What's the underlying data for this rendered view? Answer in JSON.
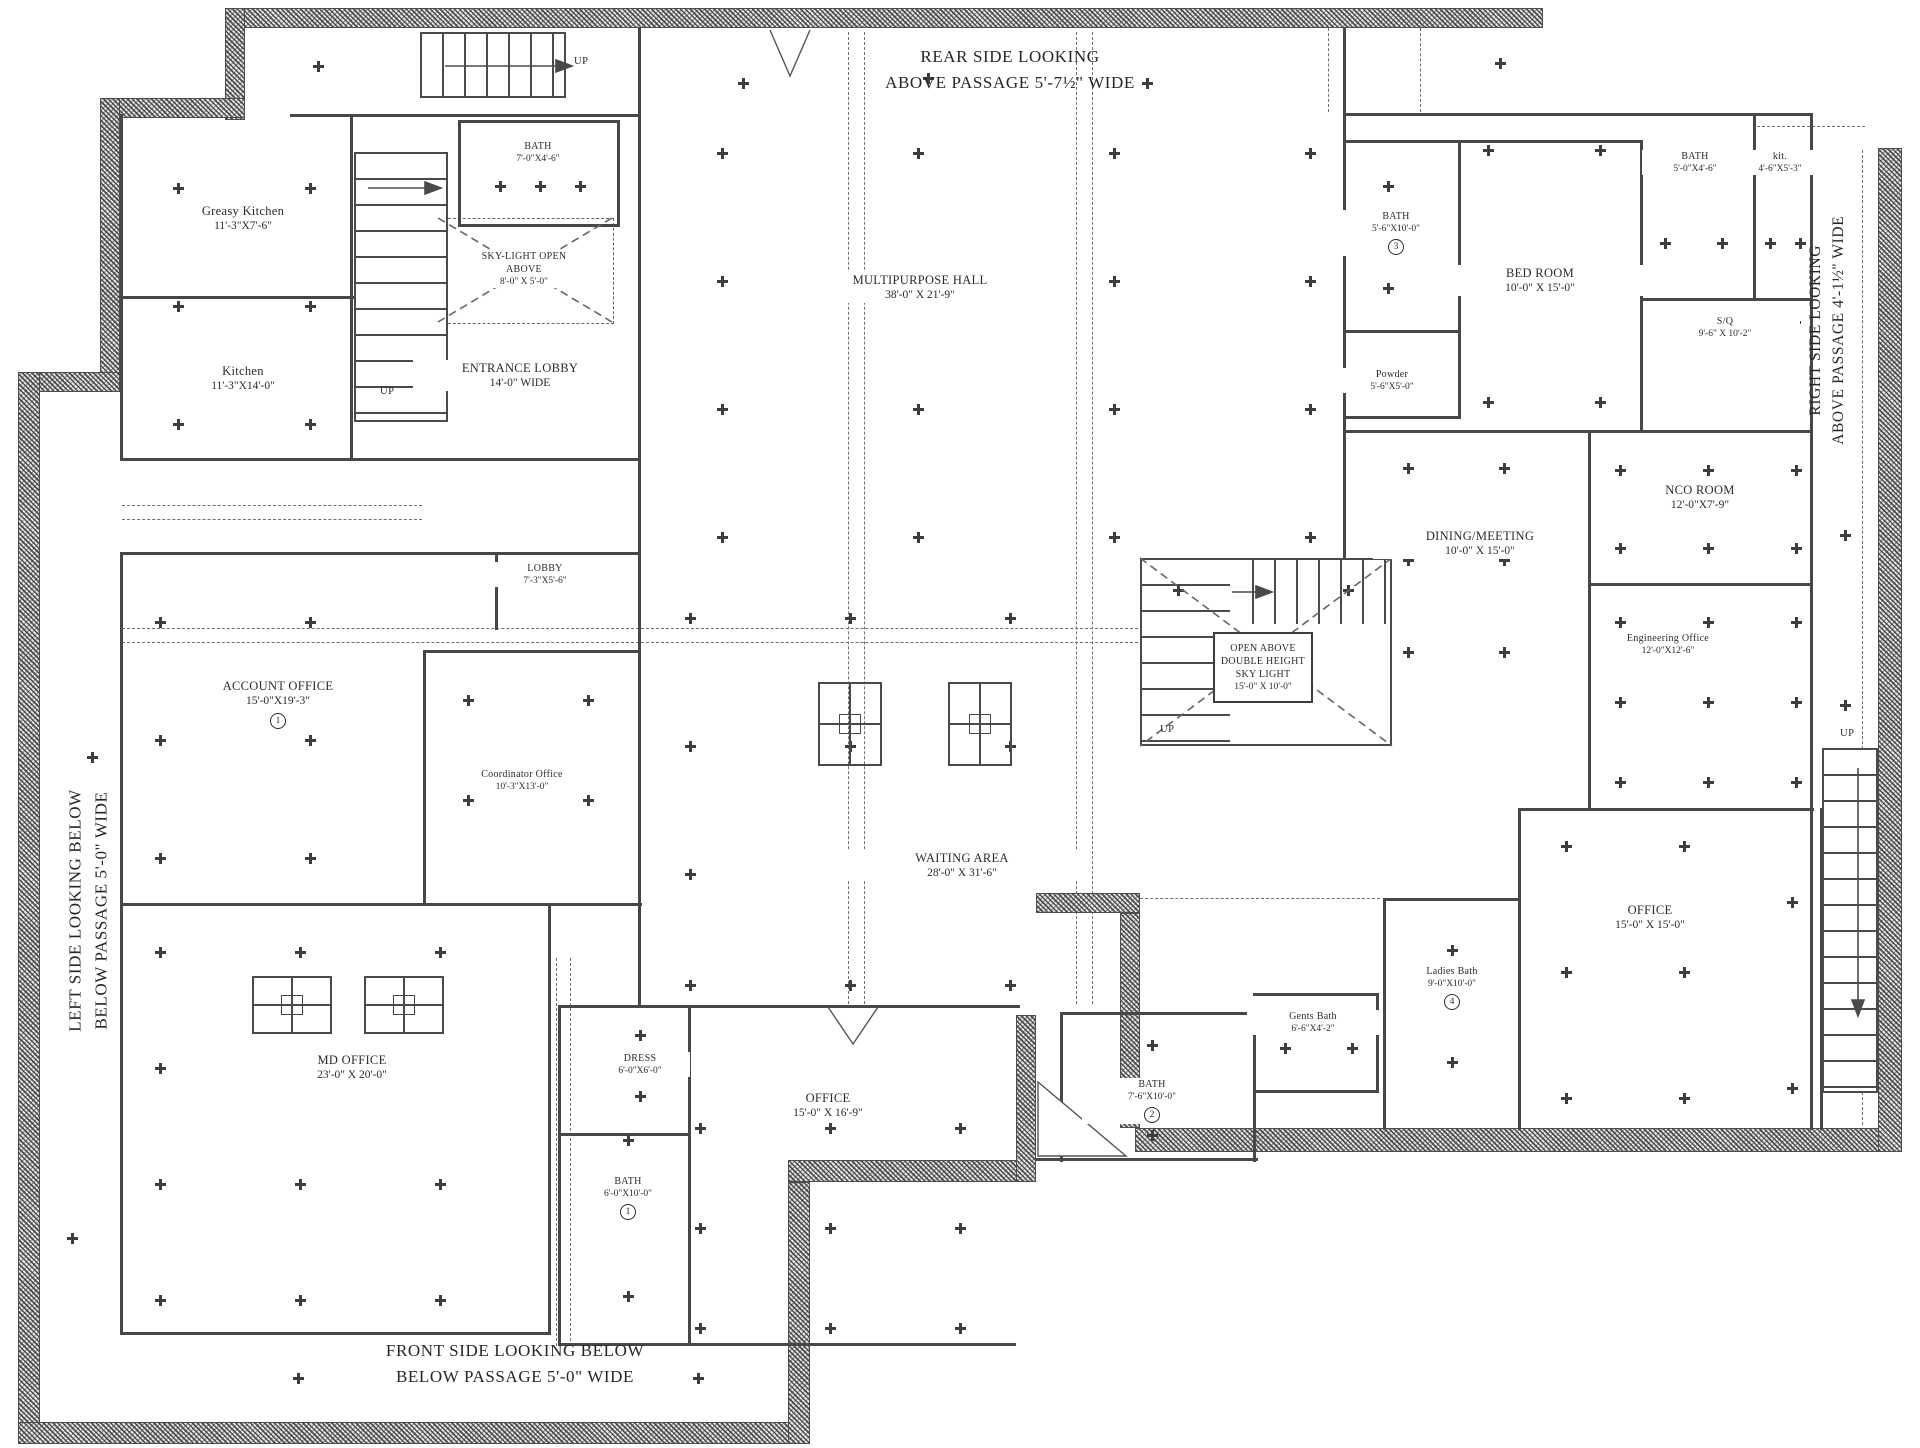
{
  "drawing": {
    "up_label": "UP",
    "notes": {
      "rear_line1": "REAR SIDE LOOKING",
      "rear_line2": "ABOVE PASSAGE 5'-7½\" WIDE",
      "front_line1": "FRONT SIDE LOOKING BELOW",
      "front_line2": "BELOW PASSAGE 5'-0\" WIDE",
      "left_line1": "LEFT SIDE LOOKING BELOW",
      "left_line2": "BELOW PASSAGE 5'-0\" WIDE",
      "right_line1": "RIGHT SIDE LOOKING",
      "right_line2": "ABOVE PASSAGE 4'-1½\" WIDE"
    },
    "rooms": {
      "greasy_kitchen": {
        "name": "Greasy Kitchen",
        "dims": "11'-3\"X7'-6\""
      },
      "kitchen": {
        "name": "Kitchen",
        "dims": "11'-3\"X14'-0\""
      },
      "bath_top": {
        "name": "BATH",
        "dims": "7'-0\"X4'-6\""
      },
      "skylight": {
        "name": "SKY-LIGHT OPEN ABOVE",
        "dims": "8'-0\" X 5'-0\""
      },
      "entrance_lobby": {
        "name": "ENTRANCE LOBBY",
        "dims": "14'-0\" WIDE"
      },
      "multipurpose_hall": {
        "name": "MULTIPURPOSE HALL",
        "dims": "38'-0\" X 21'-9\""
      },
      "bath_master": {
        "name": "BATH",
        "dims": "5'-6\"X10'-0\"",
        "badge": "3"
      },
      "powder": {
        "name": "Powder",
        "dims": "5'-6\"X5'-0\""
      },
      "bed_room": {
        "name": "BED ROOM",
        "dims": "10'-0\" X 15'-0\""
      },
      "bath_top_right": {
        "name": "BATH",
        "dims": "5'-0\"X4'-6\""
      },
      "kit_top_right": {
        "name": "kit.",
        "dims": "4'-6\"X5'-3\""
      },
      "servant_quarter": {
        "name": "S/Q",
        "dims": "9'-6\" X 10'-2\""
      },
      "nco_room": {
        "name": "NCO ROOM",
        "dims": "12'-0\"X7'-9\""
      },
      "engineering_office": {
        "name": "Engineering Office",
        "dims": "12'-0\"X12'-6\""
      },
      "dining_meeting": {
        "name": "DINING/MEETING",
        "dims": "10'-0\" X 15'-0\""
      },
      "open_above": {
        "name": "OPEN ABOVE DOUBLE HEIGHT SKY LIGHT",
        "dims": "15'-0\" X 10'-0\""
      },
      "lobby": {
        "name": "LOBBY",
        "dims": "7'-3\"X5'-6\""
      },
      "account_office": {
        "name": "ACCOUNT OFFICE",
        "dims": "15'-0\"X19'-3\"",
        "badge": "1"
      },
      "coordinator_office": {
        "name": "Coordinator Office",
        "dims": "10'-3\"X13'-0\""
      },
      "waiting_area": {
        "name": "WAITING AREA",
        "dims": "28'-0\" X 31'-6\""
      },
      "md_office": {
        "name": "MD OFFICE",
        "dims": "23'-0\" X 20'-0\""
      },
      "dress": {
        "name": "DRESS",
        "dims": "6'-0\"X6'-0\""
      },
      "bath_md": {
        "name": "BATH",
        "dims": "6'-0\"X10'-0\"",
        "badge": "1"
      },
      "office_front": {
        "name": "OFFICE",
        "dims": "15'-0\" X 16'-9\""
      },
      "bath_two": {
        "name": "BATH",
        "dims": "7'-6\"X10'-0\"",
        "badge": "2"
      },
      "gents_bath": {
        "name": "Gents Bath",
        "dims": "6'-6\"X4'-2\""
      },
      "ladies_bath": {
        "name": "Ladies Bath",
        "dims": "9'-0\"X10'-0\"",
        "badge": "4"
      },
      "office_right": {
        "name": "OFFICE",
        "dims": "15'-0\" X 15'-0\""
      }
    }
  }
}
